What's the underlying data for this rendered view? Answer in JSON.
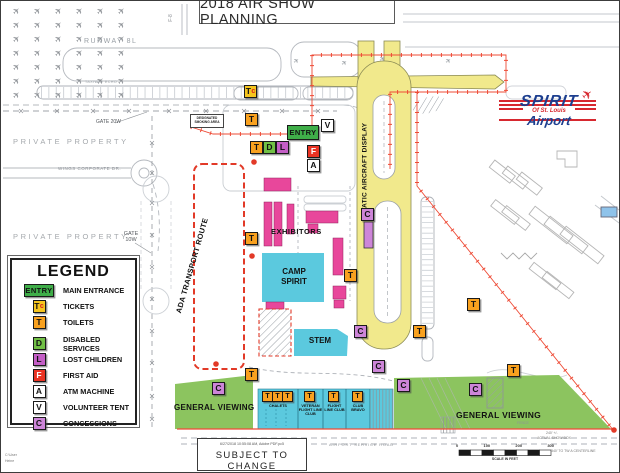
{
  "title": "2018 AIR SHOW PLANNING",
  "entry_label": "ENTRY",
  "legend": {
    "title": "LEGEND",
    "items": [
      {
        "icon": "ENTRY",
        "type": "entry",
        "label": "MAIN ENTRANCE"
      },
      {
        "icon": "Tc",
        "type": "tickets",
        "label": "TICKETS"
      },
      {
        "icon": "T",
        "type": "toilets",
        "label": "TOILETS"
      },
      {
        "icon": "D",
        "type": "disabled",
        "label": "DISABLED SERVICES",
        "gap": true
      },
      {
        "icon": "L",
        "type": "lost",
        "label": "LOST CHILDREN"
      },
      {
        "icon": "F",
        "type": "first-aid",
        "label": "FIRST AID"
      },
      {
        "icon": "A",
        "type": "atm",
        "label": "ATM MACHINE"
      },
      {
        "icon": "V",
        "type": "volunteer",
        "label": "VOLUNTEER TENT"
      },
      {
        "icon": "C",
        "type": "concessions",
        "label": "CONCESSIONS"
      }
    ]
  },
  "labels": {
    "runway": "RUNWAY 8L",
    "taxiway_echo": "TAXIWAY ECHO",
    "f8": "F-8",
    "private": "PRIVATE PROPERTY",
    "wings": "WINGS CORPORATE DR.",
    "gate20": "GATE 20W",
    "gate10": "GATE 10W",
    "smoking": "DESIGNATED SMOKING AREA",
    "ada": "ADA TRANSPORT ROUTE",
    "static_display": "STATIC AIRCRAFT DISPLAY",
    "exhibitors": "EXHIBITORS",
    "camp": "CAMP SPIRIT",
    "stem": "STEM",
    "viewing": "GENERAL VIEWING",
    "service_road": "AIRPORT SERVICE ROAD",
    "fence": "FENCE",
    "show_box1": "240' +/-",
    "show_box2": "ACTUAL SHOW BOX",
    "centerline": "340' TO TW A CENTERLINE",
    "scale_caption": "SCALE IN FEET",
    "scale_ticks": [
      "0",
      "100",
      "200",
      "300"
    ]
  },
  "club_sections": [
    {
      "label": "CHALETS",
      "x": 257,
      "w": 40,
      "t": [
        261,
        271,
        281
      ]
    },
    {
      "label": "VETERAN FLIGHT LINE CLUB",
      "x": 297,
      "w": 25,
      "t": [
        303
      ]
    },
    {
      "label": "FLIGHT LINE CLUB",
      "x": 322,
      "w": 23,
      "t": [
        327
      ]
    },
    {
      "label": "CLUB BRAVO",
      "x": 345,
      "w": 24,
      "t": [
        351
      ]
    }
  ],
  "map_icons": [
    {
      "t": "tickets",
      "l": "Tc",
      "x": 243,
      "y": 84
    },
    {
      "t": "toilets",
      "l": "T",
      "x": 244,
      "y": 112
    },
    {
      "t": "toilets",
      "l": "T",
      "x": 249,
      "y": 140
    },
    {
      "t": "disabled",
      "l": "D",
      "x": 262,
      "y": 140
    },
    {
      "t": "lost",
      "l": "L",
      "x": 275,
      "y": 140
    },
    {
      "t": "volunteer",
      "l": "V",
      "x": 320,
      "y": 118
    },
    {
      "t": "first-aid",
      "l": "F",
      "x": 306,
      "y": 144
    },
    {
      "t": "atm",
      "l": "A",
      "x": 306,
      "y": 158
    },
    {
      "t": "toilets",
      "l": "T",
      "x": 244,
      "y": 231
    },
    {
      "t": "toilets",
      "l": "T",
      "x": 343,
      "y": 268
    },
    {
      "t": "concessions",
      "l": "C",
      "x": 360,
      "y": 207
    },
    {
      "t": "concessions",
      "l": "C",
      "x": 353,
      "y": 324
    },
    {
      "t": "concessions",
      "l": "C",
      "x": 371,
      "y": 359
    },
    {
      "t": "toilets",
      "l": "T",
      "x": 244,
      "y": 367
    },
    {
      "t": "concessions",
      "l": "C",
      "x": 211,
      "y": 381
    },
    {
      "t": "concessions",
      "l": "C",
      "x": 396,
      "y": 378
    },
    {
      "t": "concessions",
      "l": "C",
      "x": 468,
      "y": 382
    },
    {
      "t": "toilets",
      "l": "T",
      "x": 506,
      "y": 363
    },
    {
      "t": "toilets",
      "l": "T",
      "x": 466,
      "y": 297
    },
    {
      "t": "toilets",
      "l": "T",
      "x": 412,
      "y": 324
    }
  ],
  "logo": {
    "name": "SPIRIT",
    "sub": "Of St. Louis",
    "word": "Airport"
  },
  "footer": {
    "timestamp": "6/27/2018 10:55:08 AM, Adobe PDF.pc5",
    "subject": "SUBJECT TO CHANGE",
    "path_line1": "C:\\User",
    "path_line2": "Heine"
  },
  "colors": {
    "booth": "#E8479B",
    "water_cyan": "#5BC9DE",
    "viewing_green": "#8CC45F",
    "taxiway_yellow": "#F1E98C",
    "route_red": "#E23A28",
    "entry_green": "#3FAE49",
    "toilets_orange": "#F9A11F",
    "concessions_purple": "#CD85D8"
  }
}
